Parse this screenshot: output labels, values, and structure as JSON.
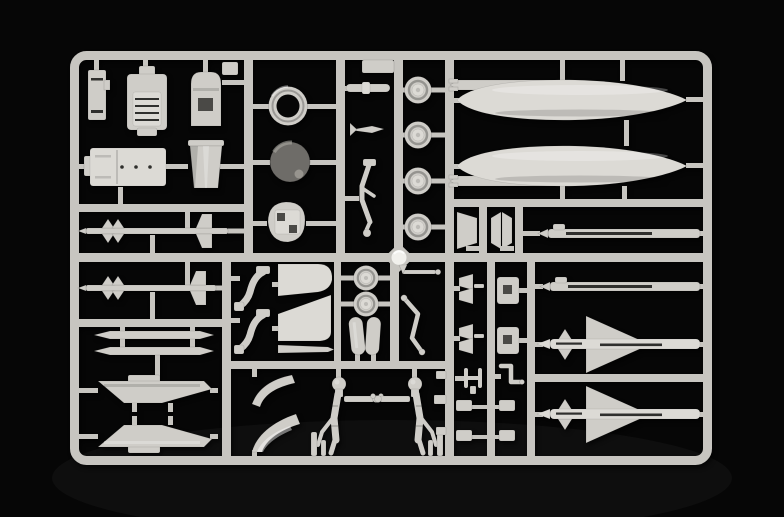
{
  "image": {
    "type": "photograph",
    "subject": "injection-molded model kit parts sprue",
    "material": "light grey polystyrene",
    "backdrop": "black studio background"
  },
  "colors": {
    "background": "#060606",
    "sprue": "#c7c5c0",
    "part": "#cfcdc8",
    "bright": "#dcdad5",
    "slot": "#2f2f2d",
    "hole": "#4a4946",
    "radome": "#6e6c68",
    "radome_tip": "#97948e",
    "ejector": "#f1f0ec"
  },
  "parts": [
    {
      "id": "side-console",
      "label": "cockpit side console"
    },
    {
      "id": "ejection-seat",
      "label": "ejection seat"
    },
    {
      "id": "seat-frame",
      "label": "seat back frame"
    },
    {
      "id": "top-bracket",
      "label": "small bracket"
    },
    {
      "id": "cockpit-tub",
      "label": "cockpit tub"
    },
    {
      "id": "exhaust-cone",
      "label": "exhaust / intake cone"
    },
    {
      "id": "intake-ring",
      "label": "engine intake ring"
    },
    {
      "id": "radome",
      "label": "radome (dark grey)"
    },
    {
      "id": "engine-bulkhead",
      "label": "bulkhead with openings"
    },
    {
      "id": "flat-bar",
      "label": "flat bar"
    },
    {
      "id": "actuator-rod",
      "label": "actuator rod"
    },
    {
      "id": "pitot-dart",
      "label": "pitot dart"
    },
    {
      "id": "nose-gear-leg",
      "label": "nose landing gear leg"
    },
    {
      "id": "main-wheels",
      "label": "main wheels x4"
    },
    {
      "id": "nose-wheels",
      "label": "nose wheels x2"
    },
    {
      "id": "drop-tank-1",
      "label": "drop tank half with fin plate"
    },
    {
      "id": "drop-tank-2",
      "label": "drop tank half with fin plate"
    },
    {
      "id": "splitter-plates",
      "label": "intake splitter plates"
    },
    {
      "id": "launch-rail-upper",
      "label": "missile launch rail"
    },
    {
      "id": "launch-rail-lower",
      "label": "missile launch rail"
    },
    {
      "id": "sidewinder-1",
      "label": "AIM-9 style missile"
    },
    {
      "id": "sidewinder-2",
      "label": "AIM-9 style missile"
    },
    {
      "id": "missile-body-halves",
      "label": "slender missile body halves x2"
    },
    {
      "id": "pylon-1",
      "label": "underwing pylon"
    },
    {
      "id": "pylon-2",
      "label": "underwing pylon (mirrored)"
    },
    {
      "id": "rudder-blades",
      "label": "curved blade parts x2"
    },
    {
      "id": "tailplane-upper",
      "label": "tailplane fin"
    },
    {
      "id": "tailplane-lower",
      "label": "tailplane fin"
    },
    {
      "id": "wing-strip",
      "label": "narrow wing strip"
    },
    {
      "id": "canopy-bands",
      "label": "curved canopy frames x2"
    },
    {
      "id": "gear-doors",
      "label": "landing gear doors x2"
    },
    {
      "id": "aoa-probe",
      "label": "probe rod"
    },
    {
      "id": "retract-strut",
      "label": "gear retraction strut"
    },
    {
      "id": "main-gear-struts",
      "label": "main landing gear struts x2"
    },
    {
      "id": "fin-clusters",
      "label": "small fin clusters x2"
    },
    {
      "id": "brackets",
      "label": "notched brackets x2"
    },
    {
      "id": "fork-fitting",
      "label": "fork fitting"
    },
    {
      "id": "angled-clip",
      "label": "angled clip"
    },
    {
      "id": "small-fittings",
      "label": "small fittings x4"
    },
    {
      "id": "rail-tabs",
      "label": "rail tabs x3"
    },
    {
      "id": "sparrow-1",
      "label": "delta-fin missile"
    },
    {
      "id": "sparrow-2",
      "label": "delta-fin missile"
    },
    {
      "id": "ejector-pad",
      "label": "shiny ejector pin pad"
    }
  ]
}
